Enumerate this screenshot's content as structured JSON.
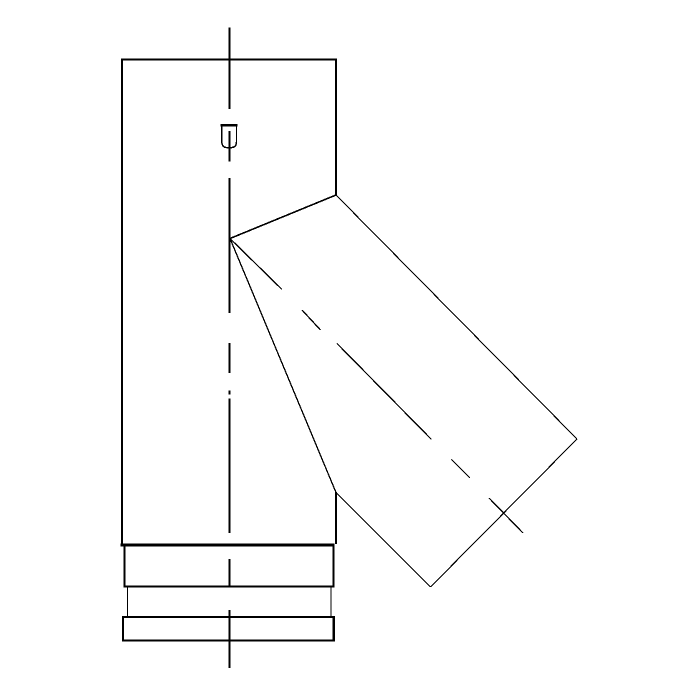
{
  "meta": {
    "background_color": "#ffffff",
    "line_color": "#000000"
  },
  "drawing": {
    "description": "CAD side elevation of a 45-degree lateral tee pipe fitting with bottom collar rings and seam detail",
    "canvas": {
      "width": 700,
      "height": 700
    },
    "stroke_color": "#000000",
    "shapes": [
      {
        "name": "main-axis-centerline",
        "type": "lines",
        "width": 1.8,
        "segments": [
          [
            229.4,
            27.5,
            229.4,
            109
          ],
          [
            229.4,
            131,
            229.4,
            161.5
          ],
          [
            229.4,
            178,
            229.4,
            313
          ],
          [
            229.4,
            343,
            229.4,
            373
          ],
          [
            229.4,
            390.5,
            229.4,
            394.5
          ],
          [
            229.4,
            398.5,
            229.4,
            533
          ],
          [
            229.4,
            559,
            229.4,
            586.5
          ],
          [
            229.4,
            610,
            229.4,
            668
          ]
        ]
      },
      {
        "name": "pipe-body-left-edge",
        "type": "line",
        "width": 2,
        "points": [
          122,
          58.5,
          122,
          545
        ]
      },
      {
        "name": "pipe-body-top-edge",
        "type": "line",
        "width": 1.6,
        "points": [
          121,
          59.5,
          336.5,
          59.5
        ]
      },
      {
        "name": "pipe-body-right-edge-upper",
        "type": "line",
        "width": 2,
        "points": [
          336,
          58.5,
          336,
          195.5
        ]
      },
      {
        "name": "pipe-body-right-edge-lower",
        "type": "line",
        "width": 2,
        "points": [
          336,
          492,
          336,
          544
        ]
      },
      {
        "name": "pipe-body-bottom-edge",
        "type": "line",
        "width": 2.8,
        "points": [
          120.5,
          545,
          334.5,
          545
        ]
      },
      {
        "name": "branch-saddle-miter-line",
        "type": "line",
        "width": 1.6,
        "points": [
          230,
          238.5,
          336,
          195
        ]
      },
      {
        "name": "branch-top-edge",
        "type": "line",
        "width": 1.1,
        "points": [
          336,
          195,
          577,
          439
        ]
      },
      {
        "name": "branch-end-edge",
        "type": "line",
        "width": 1.1,
        "points": [
          577,
          439,
          430.5,
          587
        ]
      },
      {
        "name": "branch-bottom-edge",
        "type": "line",
        "width": 1.1,
        "points": [
          430.5,
          587,
          336,
          492.5
        ]
      },
      {
        "name": "branch-root-edge",
        "type": "line",
        "width": 1.3,
        "points": [
          230,
          238.5,
          336,
          492.5
        ]
      },
      {
        "name": "branch-axis-centerline",
        "type": "lines",
        "width": 1.3,
        "segments": [
          [
            230,
            238.5,
            282,
            289.5
          ],
          [
            302,
            310,
            320.5,
            330
          ],
          [
            337,
            343.5,
            431.5,
            439.5
          ],
          [
            451.5,
            459.5,
            470,
            478
          ],
          [
            489,
            498,
            523,
            533
          ]
        ]
      },
      {
        "name": "collar-band-left-edge",
        "type": "line",
        "width": 1.8,
        "points": [
          124.5,
          546,
          124.5,
          586
        ]
      },
      {
        "name": "collar-band-right-edge",
        "type": "line",
        "width": 2.2,
        "points": [
          333.5,
          546,
          333.5,
          586
        ]
      },
      {
        "name": "collar-band-bottom-edge",
        "type": "line",
        "width": 2.4,
        "points": [
          123.5,
          586.5,
          334.5,
          586.5
        ]
      },
      {
        "name": "spigot-left-edge",
        "type": "line",
        "width": 1.3,
        "points": [
          127.5,
          587.5,
          127.5,
          616.5
        ]
      },
      {
        "name": "spigot-right-edge",
        "type": "line",
        "width": 0.9,
        "points": [
          330.8,
          587.5,
          330.8,
          616.5
        ]
      },
      {
        "name": "end-ring-outline",
        "type": "rect",
        "width": 2.4,
        "x": 123,
        "y": 617,
        "w": 210.8,
        "h": 23.5
      },
      {
        "name": "seam-detail-outline",
        "type": "path",
        "width": 1.4,
        "d": "M 221.8 125.5 H 236.5 V 141.5 Q 236.5 147.6 231.2 147.6 L 227 147.6 Q 221.8 147.6 221.8 141.5 Z"
      },
      {
        "name": "seam-detail-top-edge",
        "type": "line",
        "width": 2.2,
        "points": [
          220.6,
          125.3,
          237.4,
          125.3
        ]
      }
    ]
  }
}
